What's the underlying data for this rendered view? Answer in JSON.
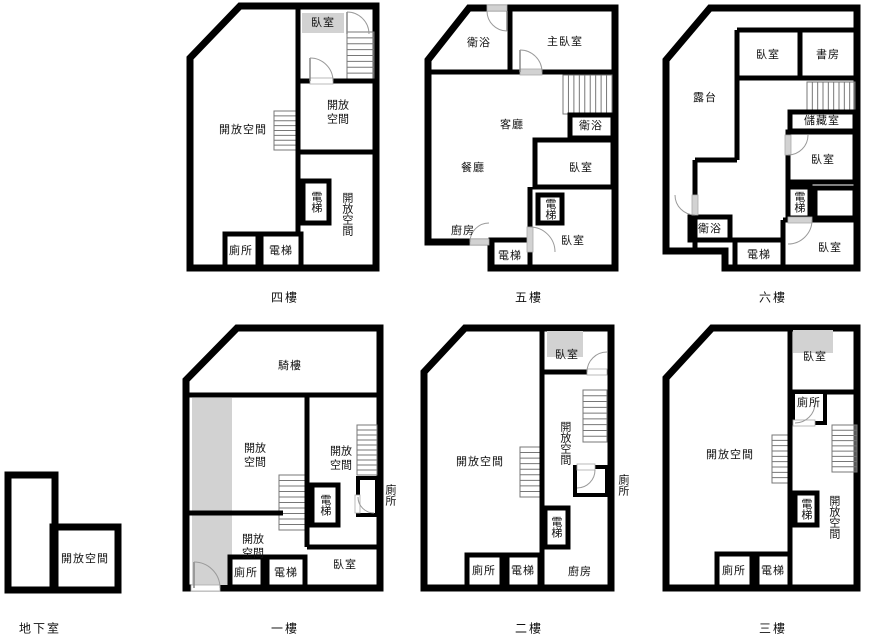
{
  "title": "樓層平面圖",
  "colors": {
    "wall": "#000000",
    "room_gray": "#d2d2d2",
    "background": "#ffffff",
    "stair_line": "#777777"
  },
  "floors": {
    "basement": {
      "name": "地下室",
      "rooms": {
        "open": "開放空間"
      }
    },
    "f1": {
      "name": "一樓",
      "rooms": {
        "arcade": "騎樓",
        "open_upper": "開放空間",
        "open_lower": "開放空間",
        "open_right": "開放空間",
        "elevator_shaft": "電梯",
        "toilet_right": "廁所",
        "toilet": "廁所",
        "elevator": "電梯",
        "bedroom": "臥室"
      }
    },
    "f2": {
      "name": "二樓",
      "rooms": {
        "bedroom": "臥室",
        "open_right": "開放空間",
        "toilet_right": "廁所",
        "open_left": "開放空間",
        "elevator_shaft": "電梯",
        "kitchen": "廚房",
        "toilet": "廁所",
        "elevator": "電梯"
      }
    },
    "f3": {
      "name": "三樓",
      "rooms": {
        "bedroom": "臥室",
        "toilet_top": "廁所",
        "open_right": "開放空間",
        "open_left": "開放空間",
        "elevator_shaft": "電梯",
        "toilet": "廁所",
        "elevator": "電梯"
      }
    },
    "f4": {
      "name": "四樓",
      "rooms": {
        "bedroom": "臥室",
        "open_right_top": "開放空間",
        "open_left": "開放空間",
        "elevator_shaft": "電梯",
        "open_right_bottom": "開放空間",
        "toilet": "廁所",
        "elevator": "電梯"
      }
    },
    "f5": {
      "name": "五樓",
      "rooms": {
        "bath_top": "衛浴",
        "master_bedroom": "主臥室",
        "living": "客廳",
        "dining": "餐廳",
        "bath_right": "衛浴",
        "bedroom_mid": "臥室",
        "elevator_shaft": "電梯",
        "kitchen": "廚房",
        "elevator": "電梯",
        "bedroom_bottom": "臥室"
      }
    },
    "f6": {
      "name": "六樓",
      "rooms": {
        "terrace": "露台",
        "bedroom_top": "臥室",
        "study": "書房",
        "storage": "儲藏室",
        "bedroom_mid": "臥室",
        "elevator_shaft": "電梯",
        "bath": "衛浴",
        "elevator": "電梯",
        "bedroom_bottom": "臥室"
      }
    }
  }
}
